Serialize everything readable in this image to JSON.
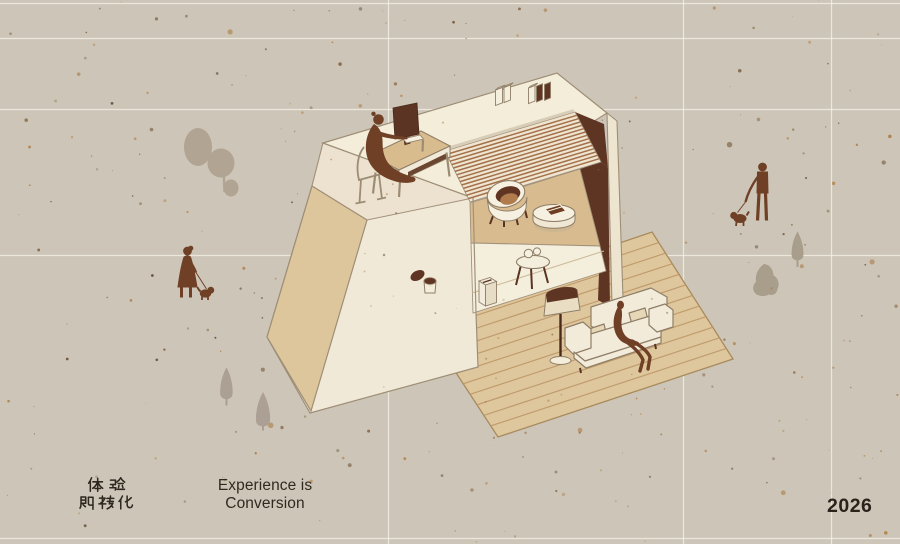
{
  "poster": {
    "title_cjk_line1": "体验",
    "title_cjk_line2": "即转化",
    "title_en_line1": "Experience is",
    "title_en_line2": "Conversion",
    "year": "2026"
  },
  "scene": {
    "description": "Isometric cutaway illustration of a two-storey studio building on speckled kraft paper",
    "elements": [
      "rooftop-terrace-with-woman-working-at-computer-desk",
      "desktop-monitor",
      "desk",
      "chair",
      "standing-books",
      "tipped-waste-bin",
      "louvered-slat-wall",
      "tub-armchair",
      "round-drum-table-with-book",
      "lower-room-side-table-with-two-cups",
      "storage-box",
      "wooden-plank-deck",
      "floor-lamp",
      "cream-sofa-with-seated-person",
      "woman-walking-dog",
      "man-walking-dog",
      "large-tree",
      "small-cypress-trees"
    ]
  },
  "grid": {
    "horizontal_y": [
      3.5,
      38.5,
      109.5,
      255.5,
      538.5
    ],
    "vertical_x": [
      388.5,
      683.5,
      831.5
    ]
  },
  "palette": {
    "background": "#cdc6b8",
    "grid_line": "#f6f3ea",
    "cream_face": "#f2ead8",
    "tan_face": "#ddc59c",
    "deck": "#dfc79d",
    "deck_plank": "#bd9769",
    "dark_wall": "#5e3423",
    "louver_stripe": "#a3714a",
    "mid_floor": "#d8bc8f",
    "figure_brown": "#6f4026",
    "outline": "#8f7e67",
    "tree_gray": "#b1a492",
    "text_dark": "#2e2720"
  }
}
